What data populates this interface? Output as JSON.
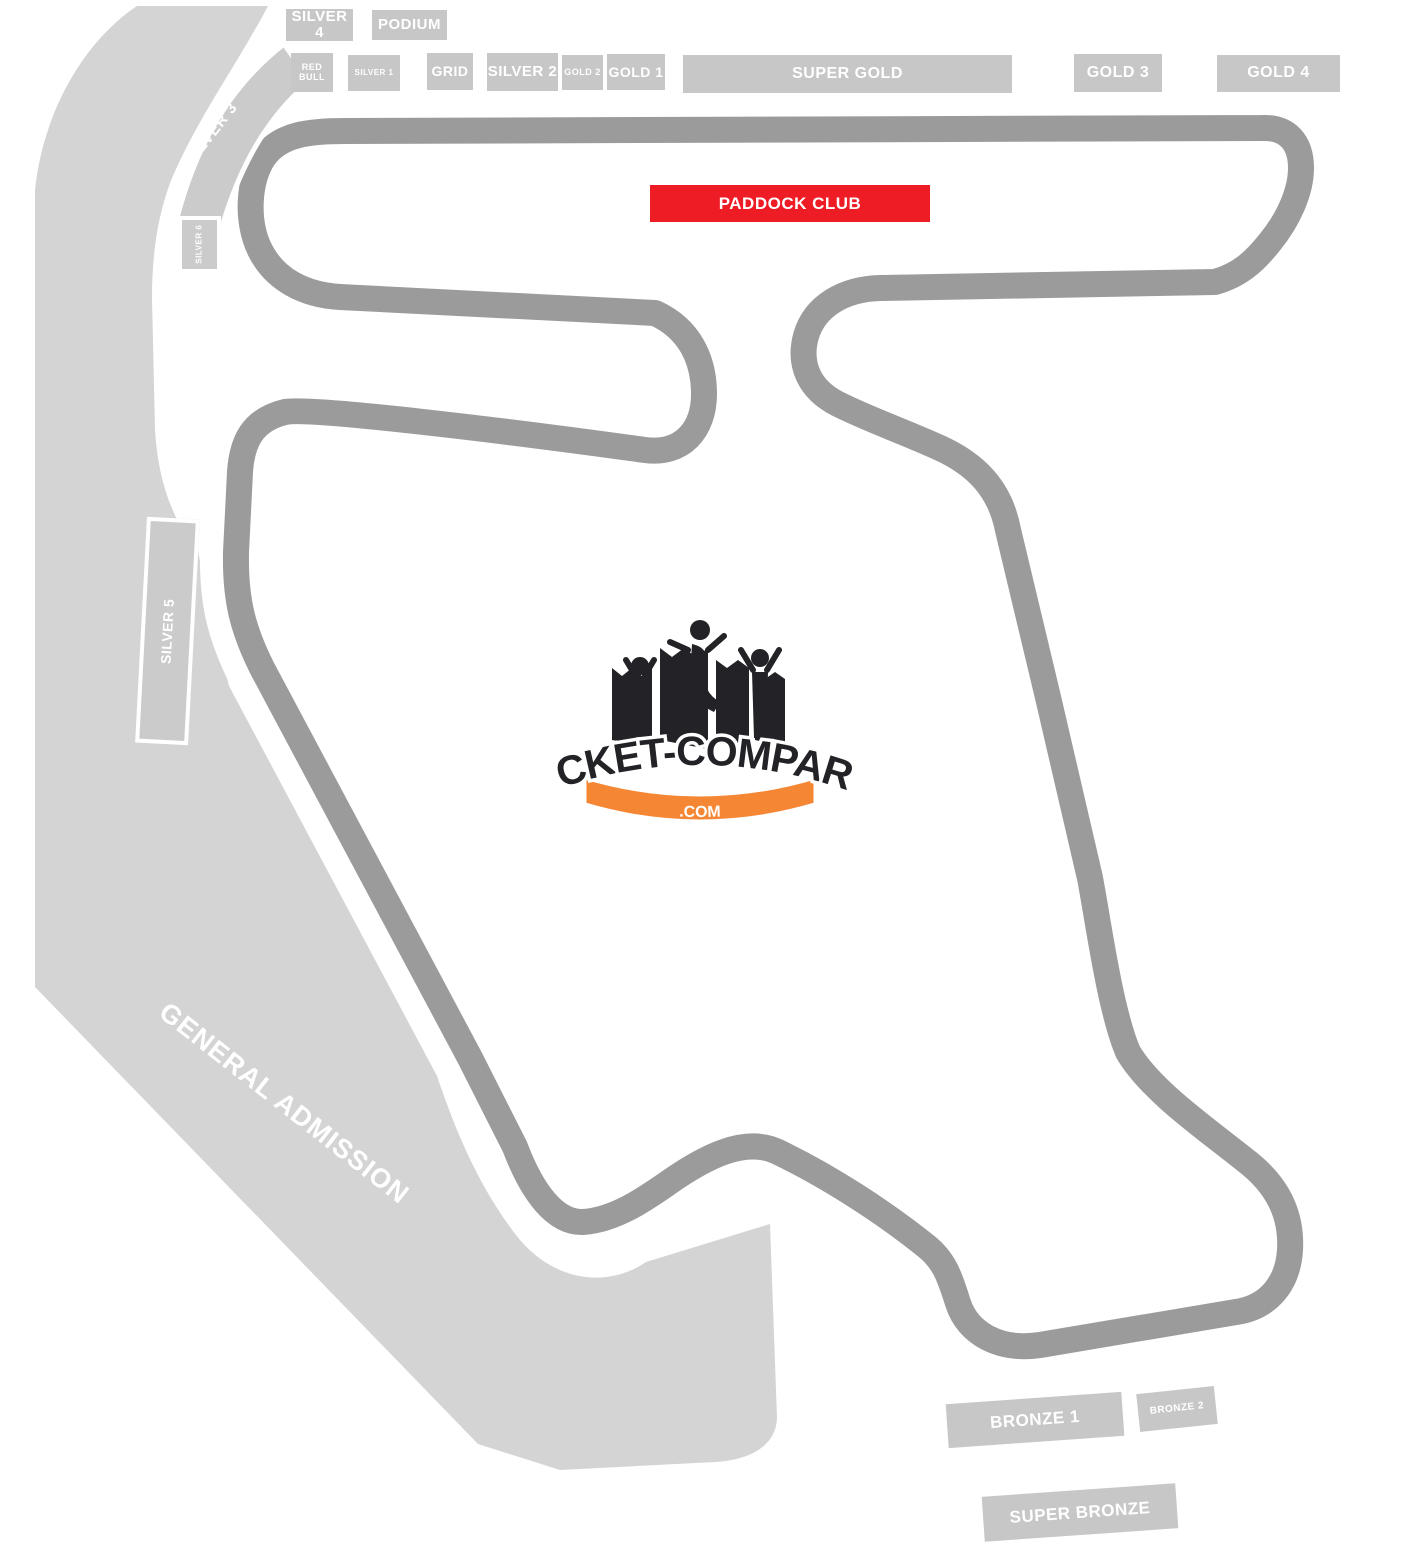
{
  "colors": {
    "track": "#9b9b9b",
    "general_admission_fill": "#d4d4d4",
    "stand_fill": "#c7c7c7",
    "paddock_red": "#ee1c24",
    "logo_dark": "#232327",
    "logo_orange": "#f58634",
    "label_text": "#ffffff"
  },
  "logo": {
    "title": "TICKET-COMPARE",
    "domain": ".COM"
  },
  "paddock_club": {
    "label": "PADDOCK CLUB"
  },
  "general_admission": {
    "label": "GENERAL ADMISSION"
  },
  "stands": {
    "silver4": "SILVER 4",
    "podium": "PODIUM",
    "red_bull": "RED BULL",
    "silver1": "SILVER 1",
    "grid": "GRID",
    "silver2": "SILVER 2",
    "gold2": "GOLD 2",
    "gold1": "GOLD 1",
    "super_gold": "SUPER GOLD",
    "gold3": "GOLD 3",
    "gold4": "GOLD 4",
    "silver3": "SILVER 3",
    "silver6": "SILVER 6",
    "silver5": "SILVER 5",
    "bronze1": "BRONZE 1",
    "bronze2": "BRONZE 2",
    "super_bronze": "SUPER BRONZE"
  }
}
